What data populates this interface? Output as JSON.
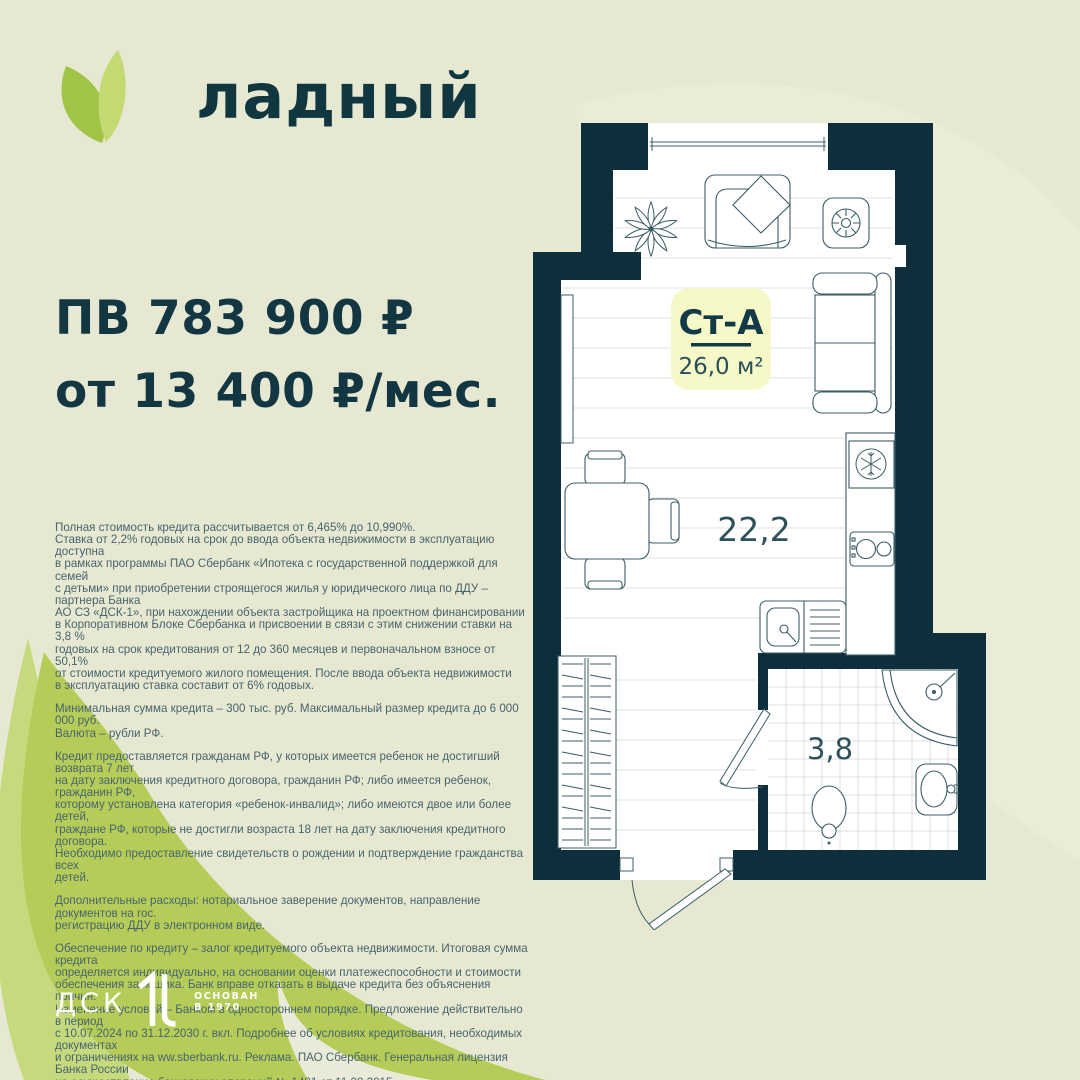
{
  "brand": {
    "name": "ладный"
  },
  "offer": {
    "down_payment": "ПВ 783 900 ₽",
    "monthly": "от 13 400 ₽/мес."
  },
  "floorplan": {
    "unit_code": "Ст-А",
    "unit_area": "26,0 м²",
    "main_room_area": "22,2",
    "bathroom_area": "3,8"
  },
  "legal": {
    "paragraphs": [
      "Полная стоимость кредита рассчитывается от 6,465% до 10,990%.\nСтавка от 2,2% годовых на срок до ввода объекта недвижимости в эксплуатацию доступна\nв рамках программы ПАО Сбербанк «Ипотека с государственной поддержкой для семей\nс детьми» при приобретении строящегося жилья у юридического лица по ДДУ  – партнера Банка\nАО СЗ «ДСК-1», при нахождении объекта застройщика на проектном финансировании\nв Корпоративном Блоке Сбербанка и присвоении в связи с этим снижении ставки на 3,8 %\nгодовых на срок кредитования от 12 до 360 месяцев и первоначальном взносе от 50,1%\nот стоимости кредитуемого жилого помещения. После ввода объекта недвижимости\nв эксплуатацию ставка составит от 6% годовых.",
      "Минимальная сумма кредита – 300 тыс. руб. Максимальный размер кредита до 6 000 000 руб.\nВалюта – рубли РФ.",
      "Кредит предоставляется гражданам РФ, у которых имеется ребенок не достигший возврата 7 лет\nна дату заключения кредитного договора, гражданин РФ; либо имеется ребенок, гражданин РФ,\nкоторому установлена категория «ребенок-инвалид»; либо имеются двое или более детей,\nграждане РФ, которые не достигли возраста 18 лет на дату заключения кредитного договора.\nНеобходимо предоставление свидетельств о рождении и подтверждение гражданства всех\nдетей.",
      "Дополнительные расходы: нотариальное заверение документов, направление документов на гос.\nрегистрацию ДДУ в электронном виде.",
      "Обеспечение по кредиту – залог кредитуемого объекта недвижимости. Итоговая сумма кредита\nопределяется индивидуально, на основании оценки платежеспособности и стоимости\nобеспечения заемщика. Банк вправе отказать в выдаче кредита без объяснения причин.\nИзменение условий – Банком в одностороннем порядке. Предложение действительно в период\nс 10.07.2024 по 31.12.2030 г. вкл. Подробнее об условиях кредитования, необходимых документах\nи ограничениях на ww.sberbank.ru. Реклама. ПАО Сбербанк. Генеральная лицензия Банка России\nна осуществление банковских операций № 1481 от 11.08.2015.\nАО Специализированный застройщик «ДСК-1».\nПроектная декларация на сайте наш.дом.рф"
    ]
  },
  "footer": {
    "company": "ДСК",
    "founded": "ОСНОВАН\nВ 1970"
  },
  "colors": {
    "background": "#e6e8d1",
    "ink": "#0f3440",
    "wall": "#0d2f3b",
    "leaf_main": "#b6cc58",
    "leaf_light": "#c6da7d",
    "logo_leaf_dark": "#9fc446",
    "logo_leaf_light": "#c3d972",
    "badge": "#f6f8c8",
    "fine_print": "#47646d"
  }
}
